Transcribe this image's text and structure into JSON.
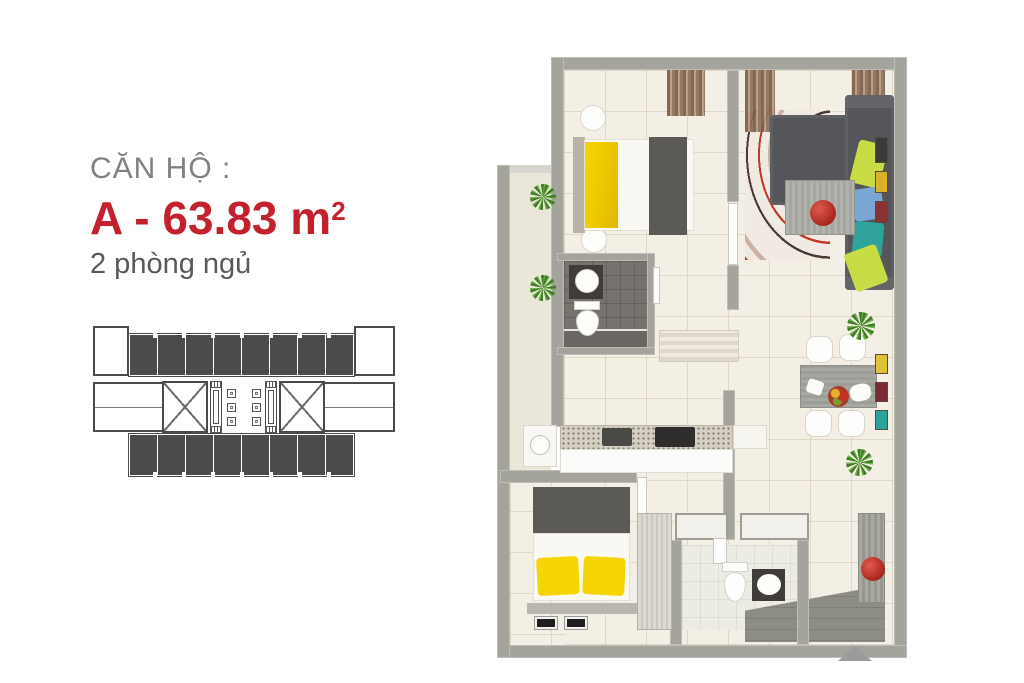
{
  "panel": {
    "label": "CĂN HỘ :",
    "area": "A - 63.83 m",
    "area_sup": "2",
    "bedrooms": "2 phòng ngủ"
  },
  "key_plan": {
    "top_units": 8,
    "bottom_units": 8,
    "lifts_left": 3,
    "lifts_right": 3
  },
  "colors": {
    "accent-red": "#c4212e",
    "label-gray": "#808184",
    "text-gray": "#58595b",
    "keyplan-unit": "#4b4b4b",
    "keyplan-line": "#4a4a4a",
    "wall": "#a5a49c",
    "floor": "#f3efe4",
    "balcony-floor": "#eae6da",
    "bath-floor": "#76726d",
    "sofa": "#54565a",
    "bed-yellow": "#f6d602",
    "pillow-lime": "#c8dc46",
    "pillow-blue": "#7ba6d4",
    "pillow-teal": "#2fa39b",
    "decor-red": "#b5281c",
    "plant-green": "#4e9a2e",
    "arrow-gray": "#9b9b9b"
  }
}
